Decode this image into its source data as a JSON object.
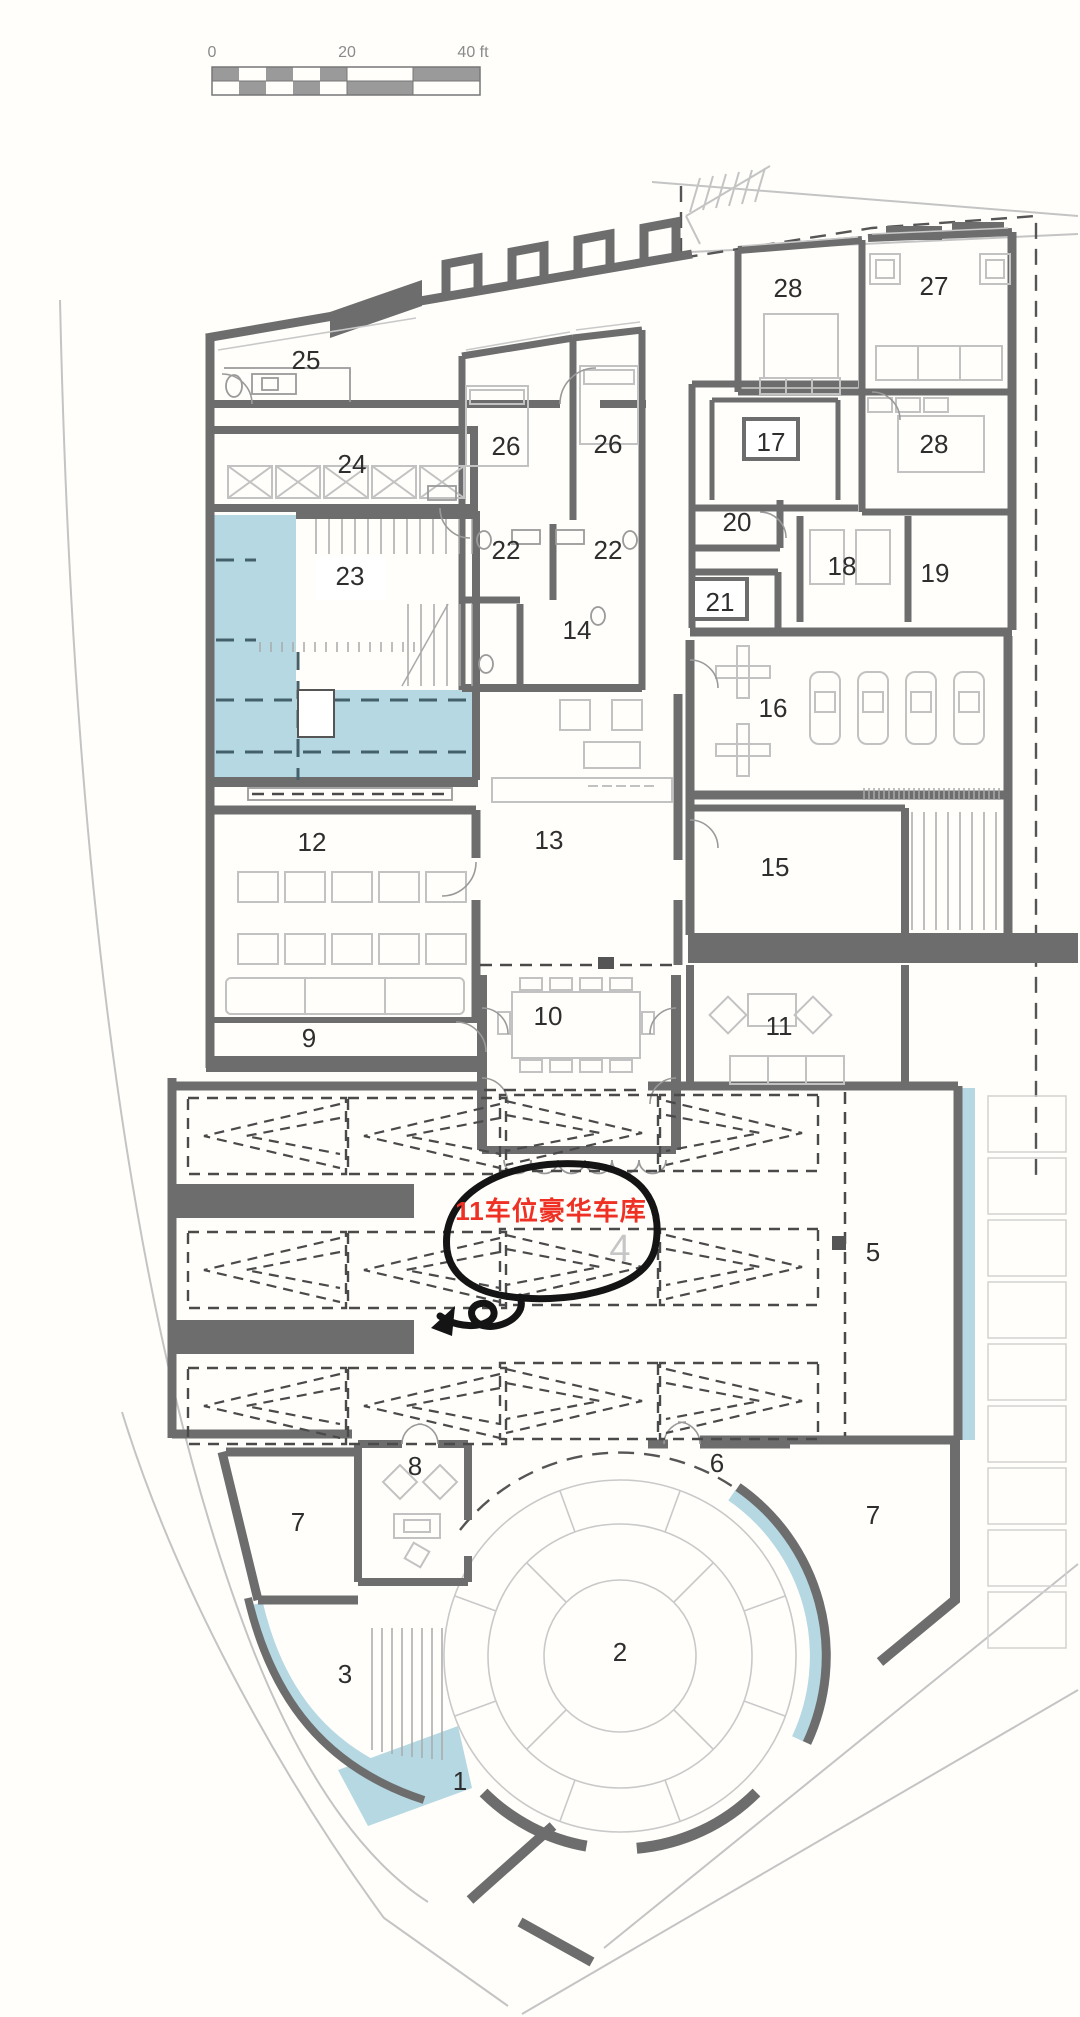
{
  "colors": {
    "wall": "#6d6d6d",
    "water": "#b5d8e2",
    "annotation": "#ee3124",
    "parking_dash": "#4a4a4a"
  },
  "scale_bar": {
    "ticks": [
      "0",
      "20",
      "40 ft"
    ]
  },
  "annotation": {
    "text": "11车位豪华车库"
  },
  "area_labels": [
    {
      "text": "25",
      "x": 306,
      "y": 369
    },
    {
      "text": "24",
      "x": 352,
      "y": 473
    },
    {
      "text": "23",
      "x": 350,
      "y": 585
    },
    {
      "text": "26",
      "x": 506,
      "y": 455
    },
    {
      "text": "26",
      "x": 608,
      "y": 453
    },
    {
      "text": "22",
      "x": 506,
      "y": 559
    },
    {
      "text": "22",
      "x": 608,
      "y": 559
    },
    {
      "text": "14",
      "x": 577,
      "y": 639
    },
    {
      "text": "28",
      "x": 788,
      "y": 297
    },
    {
      "text": "27",
      "x": 934,
      "y": 295
    },
    {
      "text": "28",
      "x": 934,
      "y": 453
    },
    {
      "text": "17",
      "x": 771,
      "y": 451,
      "box": true
    },
    {
      "text": "20",
      "x": 737,
      "y": 531
    },
    {
      "text": "21",
      "x": 720,
      "y": 611,
      "box": true
    },
    {
      "text": "18",
      "x": 842,
      "y": 575
    },
    {
      "text": "19",
      "x": 935,
      "y": 582
    },
    {
      "text": "16",
      "x": 773,
      "y": 717
    },
    {
      "text": "12",
      "x": 312,
      "y": 851
    },
    {
      "text": "13",
      "x": 549,
      "y": 849
    },
    {
      "text": "15",
      "x": 775,
      "y": 876
    },
    {
      "text": "9",
      "x": 309,
      "y": 1047
    },
    {
      "text": "10",
      "x": 548,
      "y": 1025
    },
    {
      "text": "11",
      "x": 779,
      "y": 1035
    },
    {
      "text": "5",
      "x": 873,
      "y": 1261
    },
    {
      "text": "4",
      "x": 620,
      "y": 1261,
      "cls": "gray"
    },
    {
      "text": "8",
      "x": 415,
      "y": 1475
    },
    {
      "text": "6",
      "x": 717,
      "y": 1472
    },
    {
      "text": "7",
      "x": 298,
      "y": 1531
    },
    {
      "text": "7",
      "x": 873,
      "y": 1524
    },
    {
      "text": "3",
      "x": 345,
      "y": 1683
    },
    {
      "text": "2",
      "x": 620,
      "y": 1661
    },
    {
      "text": "1",
      "x": 460,
      "y": 1790
    }
  ]
}
